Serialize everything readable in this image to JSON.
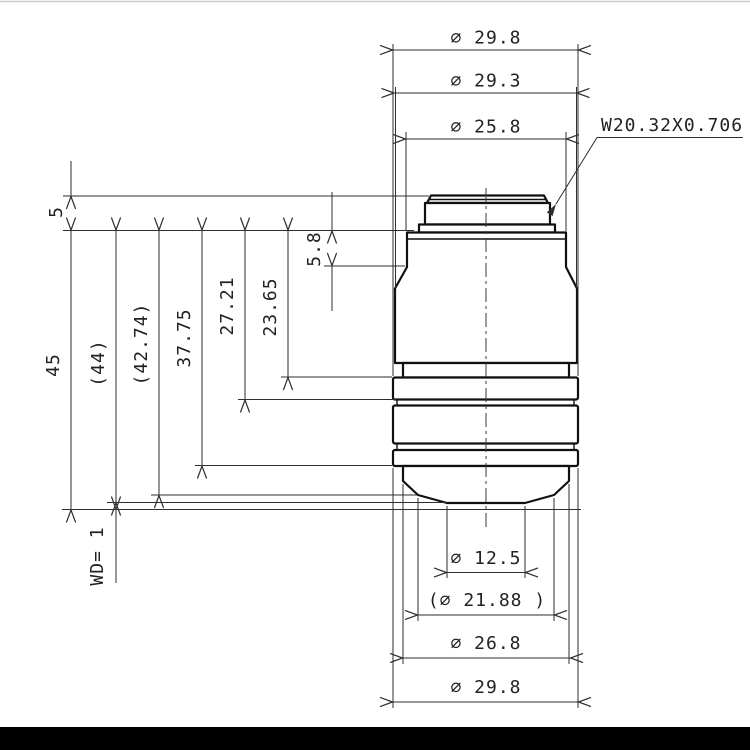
{
  "drawing": {
    "thread_callout": {
      "label": "W20.32X0.706"
    },
    "top_dimensions": [
      {
        "name": "outer-diameter-top",
        "label": "∅ 29.8"
      },
      {
        "name": "barrel-diameter",
        "label": "∅ 29.3"
      },
      {
        "name": "flange-diameter",
        "label": "∅ 25.8"
      }
    ],
    "left_dimensions": [
      {
        "name": "thread-length",
        "label": "5"
      },
      {
        "name": "parfocal-distance",
        "label": "45"
      },
      {
        "name": "length-44",
        "label": "(44)"
      },
      {
        "name": "length-42-74",
        "label": "(42.74)"
      },
      {
        "name": "length-37-75",
        "label": "37.75"
      },
      {
        "name": "length-27-21",
        "label": "27.21"
      },
      {
        "name": "length-23-65",
        "label": "23.65"
      },
      {
        "name": "shoulder-depth",
        "label": "5.8"
      },
      {
        "name": "working-distance",
        "label": "WD= 1"
      }
    ],
    "bottom_dimensions": [
      {
        "name": "tip-diameter",
        "label": "∅ 12.5"
      },
      {
        "name": "front-cone-diameter",
        "label": "(∅ 21.88 )"
      },
      {
        "name": "front-barrel-diameter",
        "label": "∅ 26.8"
      },
      {
        "name": "outer-diameter-bottom",
        "label": "∅ 29.8"
      }
    ]
  }
}
